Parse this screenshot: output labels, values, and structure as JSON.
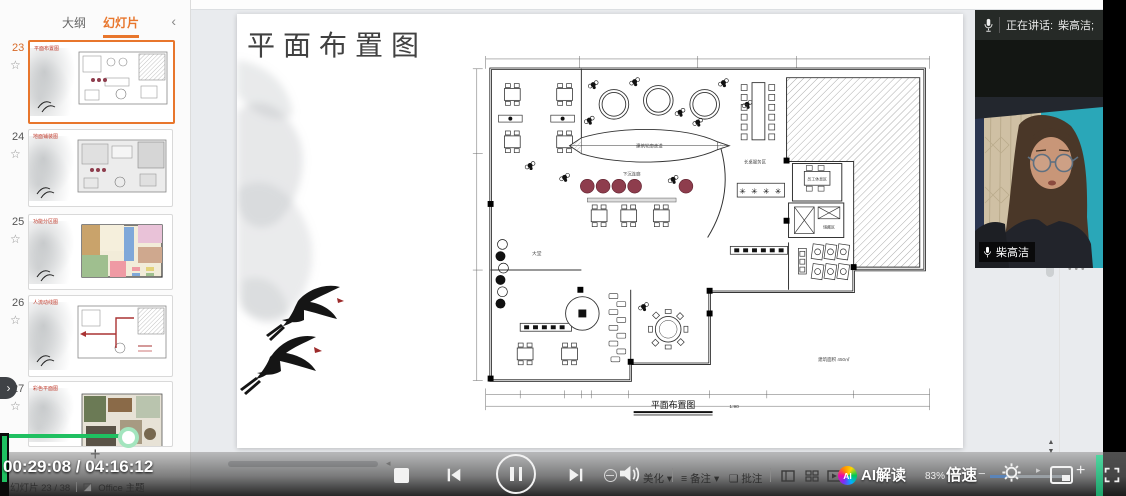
{
  "panel": {
    "tab_outline": "大纲",
    "tab_slides": "幻灯片",
    "collapse_icon": "‹",
    "expand_icon": "›",
    "star": "☆",
    "add_label": "+",
    "thumbnails": [
      {
        "num": "23",
        "title": "平面布置图"
      },
      {
        "num": "24",
        "title": "地面铺装图"
      },
      {
        "num": "25",
        "title": "功能分区图"
      },
      {
        "num": "26",
        "title": "人流动线图"
      },
      {
        "num": "27",
        "title": "彩色平面图"
      }
    ]
  },
  "slide": {
    "title": "平面布置图",
    "plan": {
      "caption": "平面布置图",
      "scale": "1:90",
      "area": "建筑面积 450㎡",
      "label_lobby": "大堂",
      "label_sunken": "下沉连廊",
      "label_walkway": "建筑轮廓走道",
      "label_longtable": "长桌服务区",
      "label_staff": "员工休息区",
      "label_storage": "储藏区"
    }
  },
  "meeting": {
    "speaking_prefix": "正在讲话:",
    "speaking_name": "柴高洁;",
    "name_tag": "柴高洁",
    "overflow_dots": "•••"
  },
  "statusbar": {
    "slide_counter": "幻灯片 23 / 38",
    "theme": "Office 主题",
    "beautify": "美化",
    "notes": "备注",
    "comments": "批注",
    "caret": "▾",
    "zoom": "83%"
  },
  "player": {
    "time": "00:29:08 / 04:16:12",
    "ai_badge": "AI",
    "ai_label": "AI解读",
    "speed": "倍速",
    "minus": "−",
    "plus": "+",
    "tiny_play": "▸",
    "colors": {
      "progress_green": "#1fc061",
      "accent_strip": "#2ec487",
      "tab_orange": "#e8762c"
    }
  }
}
